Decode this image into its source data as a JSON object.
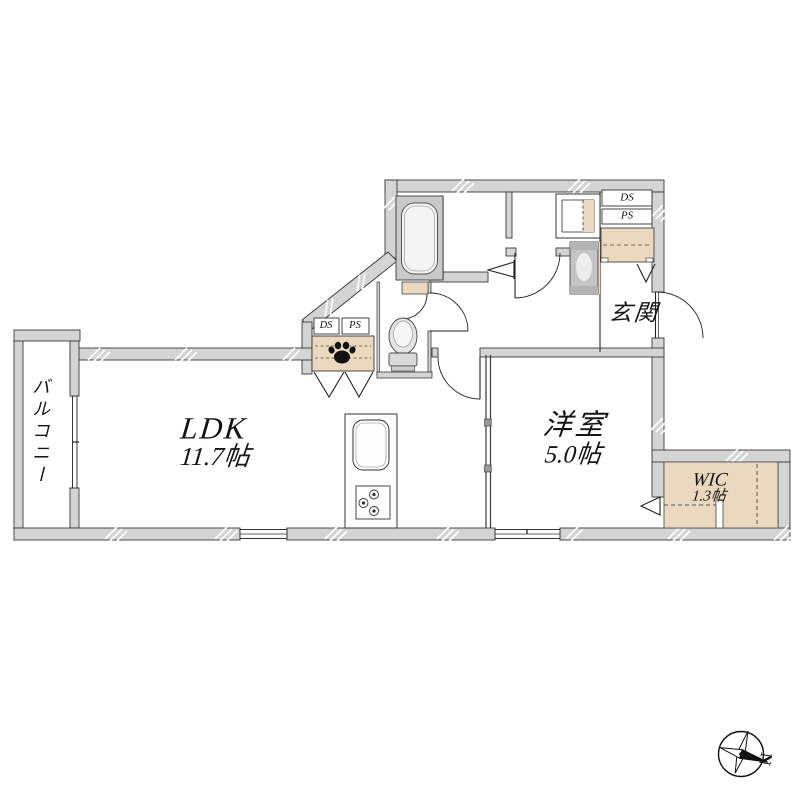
{
  "floor_plan": {
    "rooms": {
      "ldk": {
        "label": "LDK",
        "area": "11.7帖"
      },
      "youshitsu": {
        "label": "洋室",
        "area": "5.0帖"
      },
      "wic": {
        "label": "WIC",
        "area": "1.3帖"
      },
      "genkan": {
        "label": "玄関"
      },
      "balcony": {
        "label": "バルコニー"
      }
    },
    "ducts": {
      "ds_upper": "DS",
      "ps_upper": "PS",
      "ds_ldk": "DS",
      "ps_ldk": "PS"
    },
    "compass": {
      "north_label": "N"
    },
    "colors": {
      "wall_fill": "#d4d4d4",
      "wall_line": "#3a3a3a",
      "fixture_beige": "#ead9bf",
      "bath_gray": "#c9c9c9",
      "unit_gray": "#c4c4c4",
      "paw_black": "#111111"
    }
  }
}
